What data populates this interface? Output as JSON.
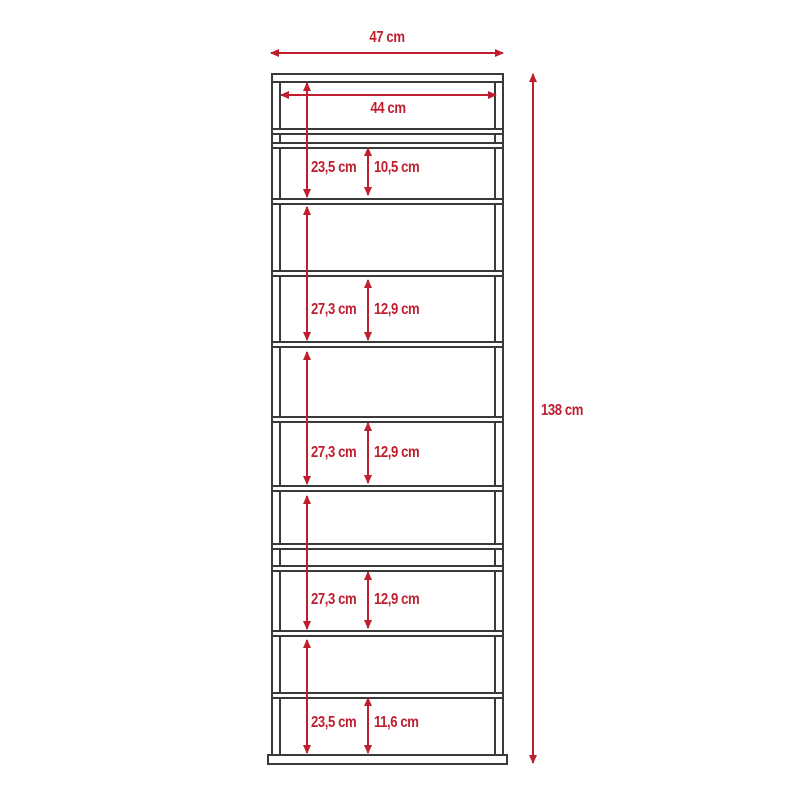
{
  "diagram": {
    "type": "furniture-dimension-diagram",
    "unit": "cm",
    "colors": {
      "dimension_red": "#be1e2d",
      "outline_gray": "#3a3a3a",
      "background": "#ffffff"
    },
    "overall_dimensions": {
      "outer_width": "47 cm",
      "inner_width": "44 cm",
      "height": "138 cm"
    },
    "compartments": [
      {
        "outer_height": "23,5 cm",
        "inner_height": "10,5 cm"
      },
      {
        "outer_height": "27,3 cm",
        "inner_height": "12,9 cm"
      },
      {
        "outer_height": "27,3 cm",
        "inner_height": "12,9 cm"
      },
      {
        "outer_height": "27,3 cm",
        "inner_height": "12,9 cm"
      },
      {
        "outer_height": "23,5 cm",
        "inner_height": "11,6 cm"
      }
    ]
  }
}
